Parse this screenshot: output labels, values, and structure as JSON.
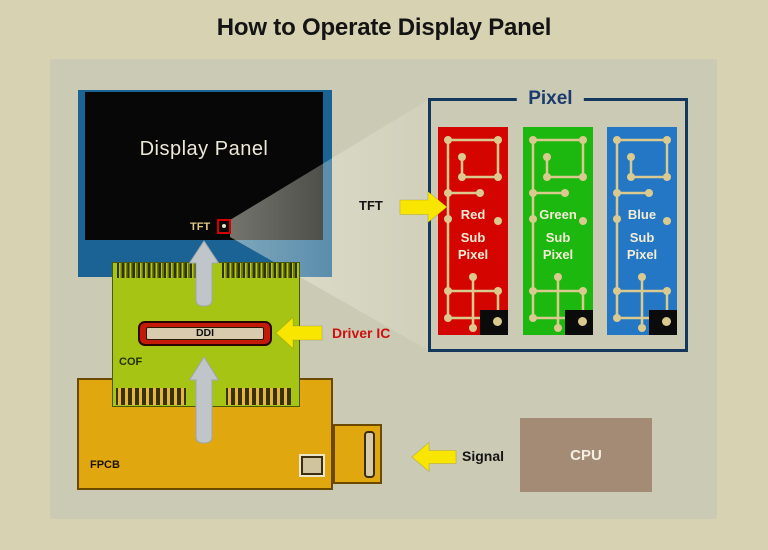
{
  "title": "How to Operate Display Panel",
  "display_panel": {
    "label": "Display Panel",
    "tft_label": "TFT"
  },
  "cof": {
    "label": "COF",
    "chip_label": "DDI"
  },
  "fpcb": {
    "label": "FPCB"
  },
  "cpu": {
    "label": "CPU"
  },
  "annotations": {
    "driver_ic": "Driver IC",
    "signal": "Signal",
    "tft": "TFT"
  },
  "pixel_inset": {
    "title": "Pixel",
    "subpixels": [
      {
        "name": "Red",
        "line2": "Sub",
        "line3": "Pixel",
        "color_key": "subpixel_red"
      },
      {
        "name": "Green",
        "line2": "Sub",
        "line3": "Pixel",
        "color_key": "subpixel_green"
      },
      {
        "name": "Blue",
        "line2": "Sub",
        "line3": "Pixel",
        "color_key": "subpixel_blue"
      }
    ]
  },
  "icons": {
    "up_arrows": "gray up-arrow from FPCB to DDI and from COF to panel",
    "driver_ic_arrow": "yellow left-arrow",
    "tft_arrow": "yellow right-arrow",
    "signal_arrow": "yellow left-arrow",
    "light_cone": "beam from TFT point to pixel inset"
  },
  "colors": {
    "background": "#d7d2b2",
    "background_inner": "#cbcab4",
    "panel_blue": "#1b6394",
    "screen_black": "#070707",
    "cof_green": "#a6c414",
    "fpcb_gold": "#e0a70e",
    "cpu_brown": "#a38b75",
    "arrow_yellow": "#f8e600",
    "arrow_gray": "#bfc5c9",
    "subpixel_red": "#d40500",
    "subpixel_green": "#1cb80f",
    "subpixel_blue": "#2377c4",
    "pixel_border": "#14375e",
    "trace_cream": "#dbca90",
    "driver_ic_red": "#cc1111",
    "title_ink": "#141414"
  }
}
